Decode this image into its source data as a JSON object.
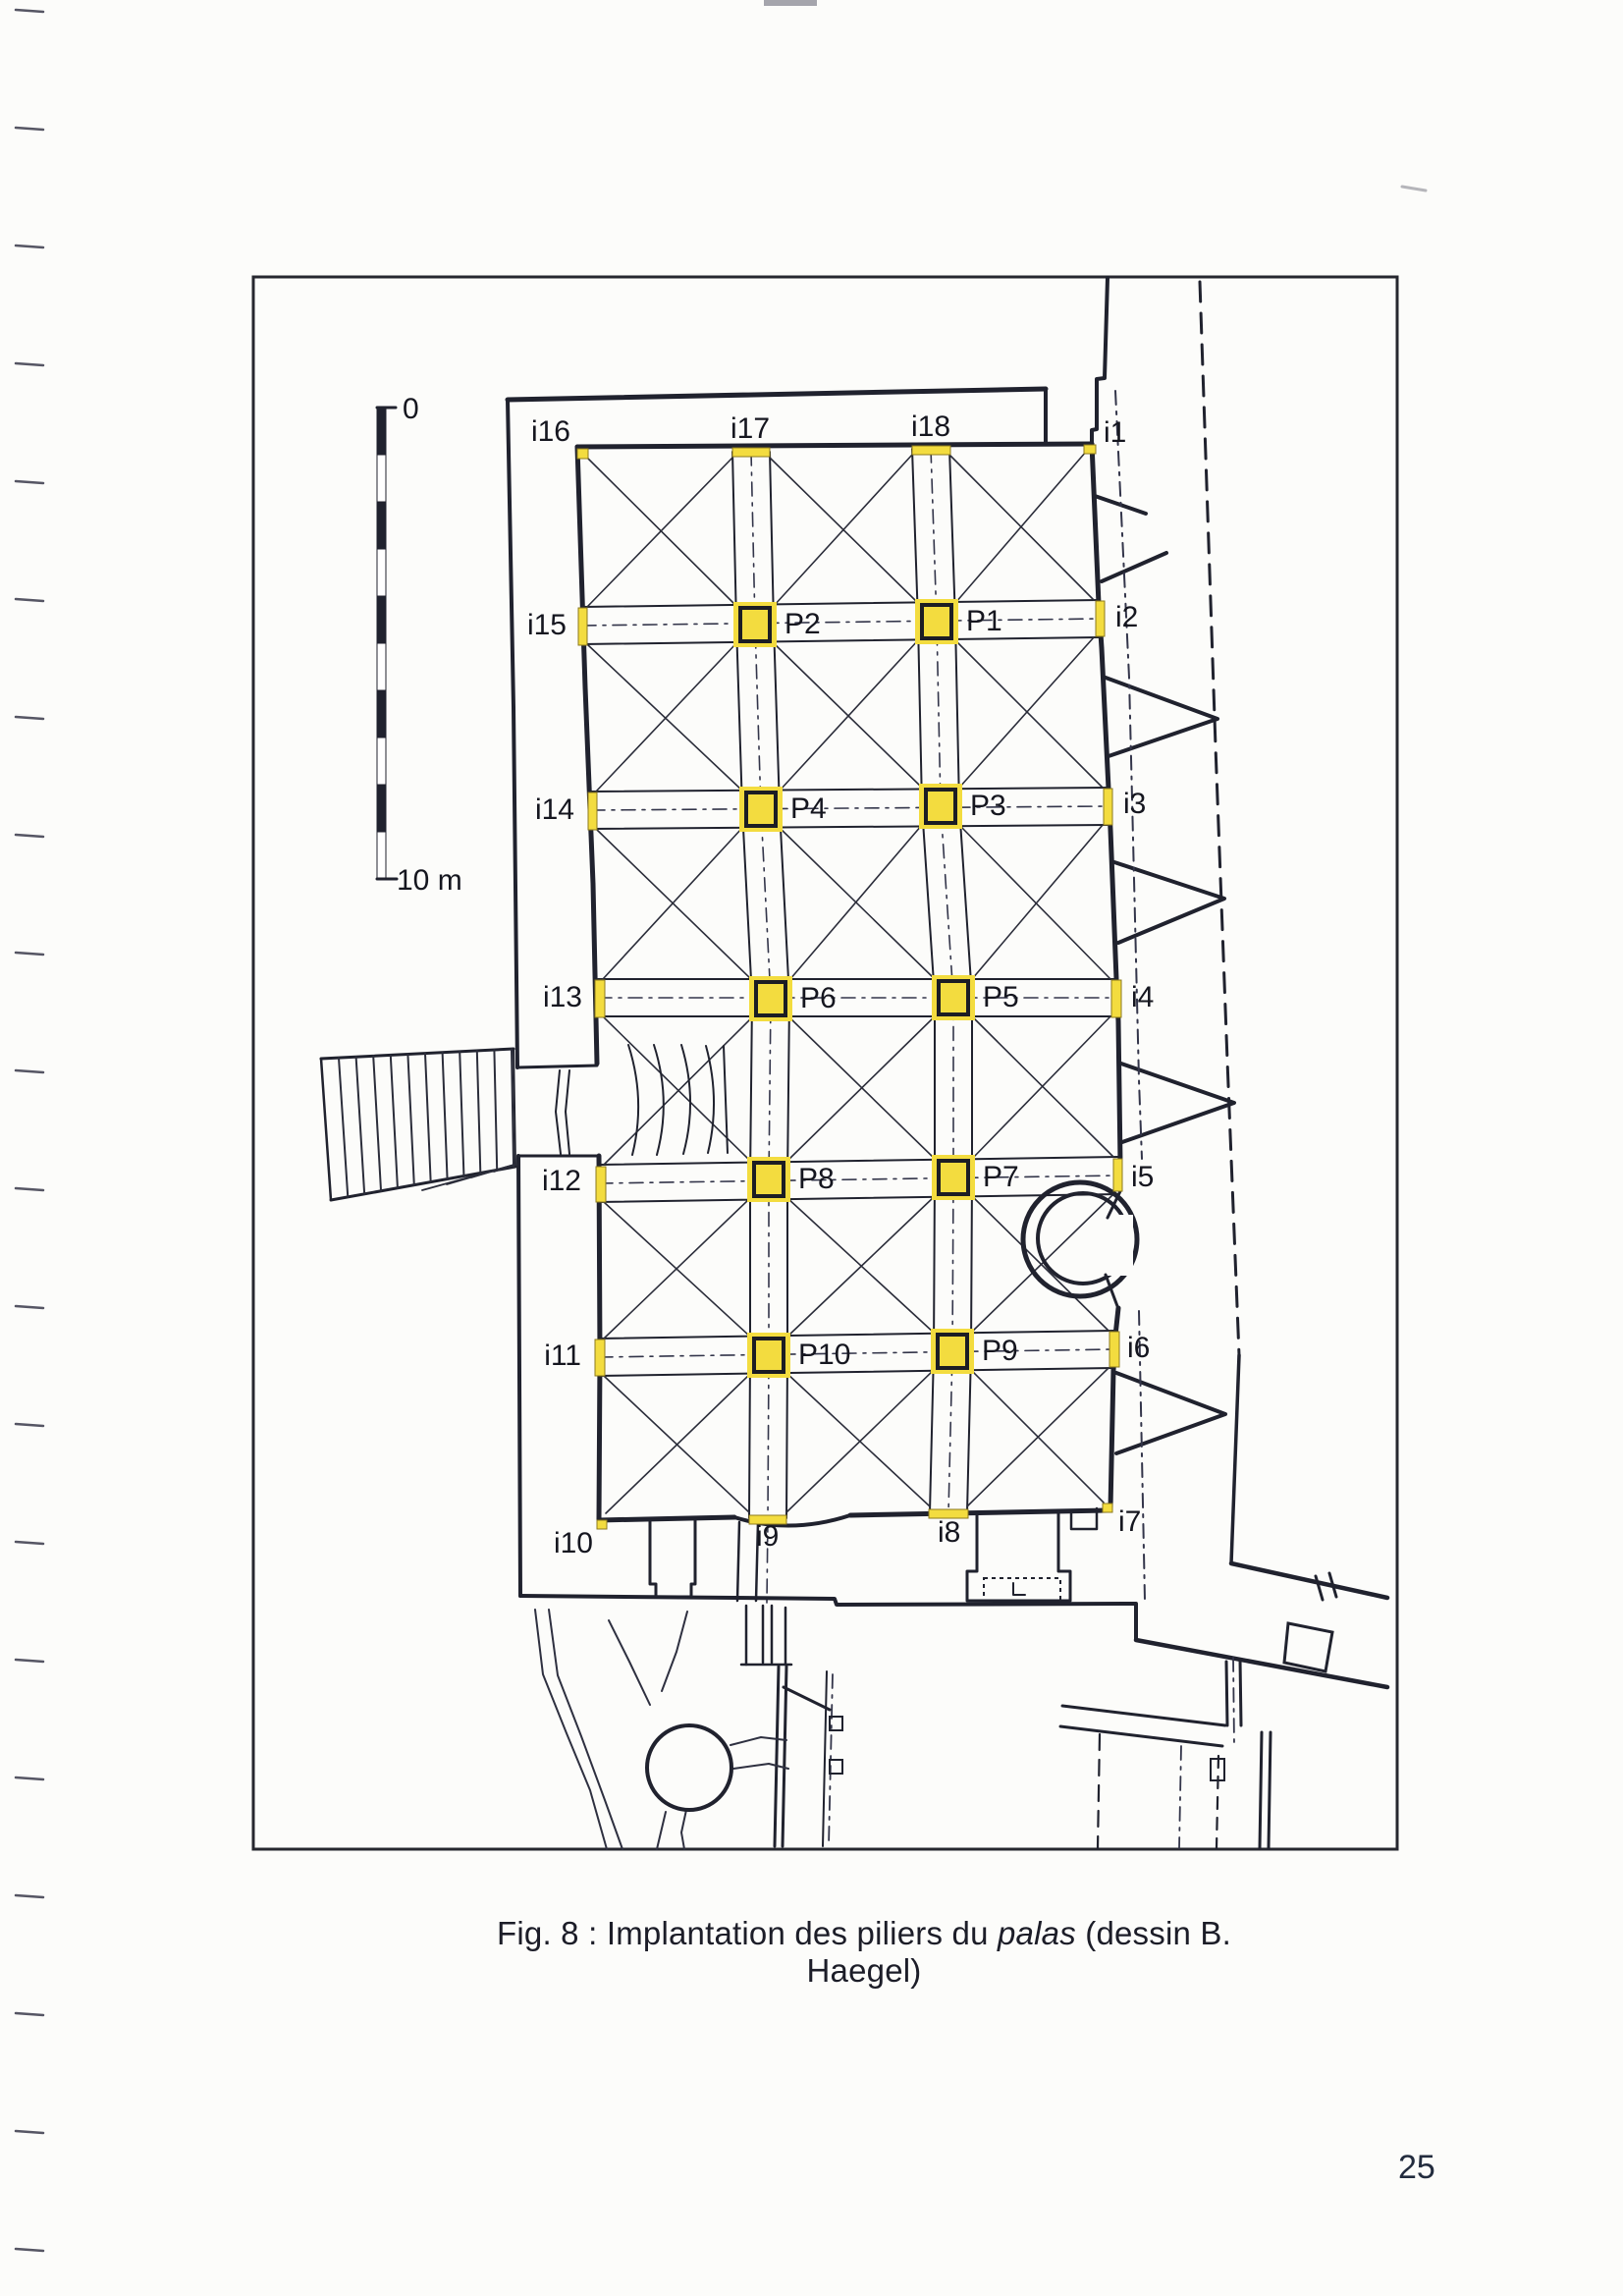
{
  "document": {
    "caption": {
      "prefix": "Fig. 8 : Implantation des piliers du ",
      "italic_word": "palas",
      "suffix": " (dessin B. Haegel)"
    },
    "page_number": "25"
  },
  "figure": {
    "scale_bar": {
      "top_label": "0",
      "bottom_label": "10 m"
    },
    "pillars": [
      {
        "id": "P1",
        "label": "P1"
      },
      {
        "id": "P2",
        "label": "P2"
      },
      {
        "id": "P3",
        "label": "P3"
      },
      {
        "id": "P4",
        "label": "P4"
      },
      {
        "id": "P5",
        "label": "P5"
      },
      {
        "id": "P6",
        "label": "P6"
      },
      {
        "id": "P7",
        "label": "P7"
      },
      {
        "id": "P8",
        "label": "P8"
      },
      {
        "id": "P9",
        "label": "P9"
      },
      {
        "id": "P10",
        "label": "P10"
      }
    ],
    "imposts": [
      {
        "id": "i1",
        "label": "i1"
      },
      {
        "id": "i2",
        "label": "i2"
      },
      {
        "id": "i3",
        "label": "i3"
      },
      {
        "id": "i4",
        "label": "i4"
      },
      {
        "id": "i5",
        "label": "i5"
      },
      {
        "id": "i6",
        "label": "i6"
      },
      {
        "id": "i7",
        "label": "i7"
      },
      {
        "id": "i8",
        "label": "i8"
      },
      {
        "id": "i9",
        "label": "i9"
      },
      {
        "id": "i10",
        "label": "i10"
      },
      {
        "id": "i11",
        "label": "i11"
      },
      {
        "id": "i12",
        "label": "i12"
      },
      {
        "id": "i13",
        "label": "i13"
      },
      {
        "id": "i14",
        "label": "i14"
      },
      {
        "id": "i15",
        "label": "i15"
      },
      {
        "id": "i16",
        "label": "i16"
      },
      {
        "id": "i17",
        "label": "i17"
      },
      {
        "id": "i18",
        "label": "i18"
      }
    ],
    "colors": {
      "ink": "#20222e",
      "thin_line": "#2b2d3a",
      "pillar_fill": "#f3dc3f",
      "pillar_border": "#1c1d24"
    }
  }
}
